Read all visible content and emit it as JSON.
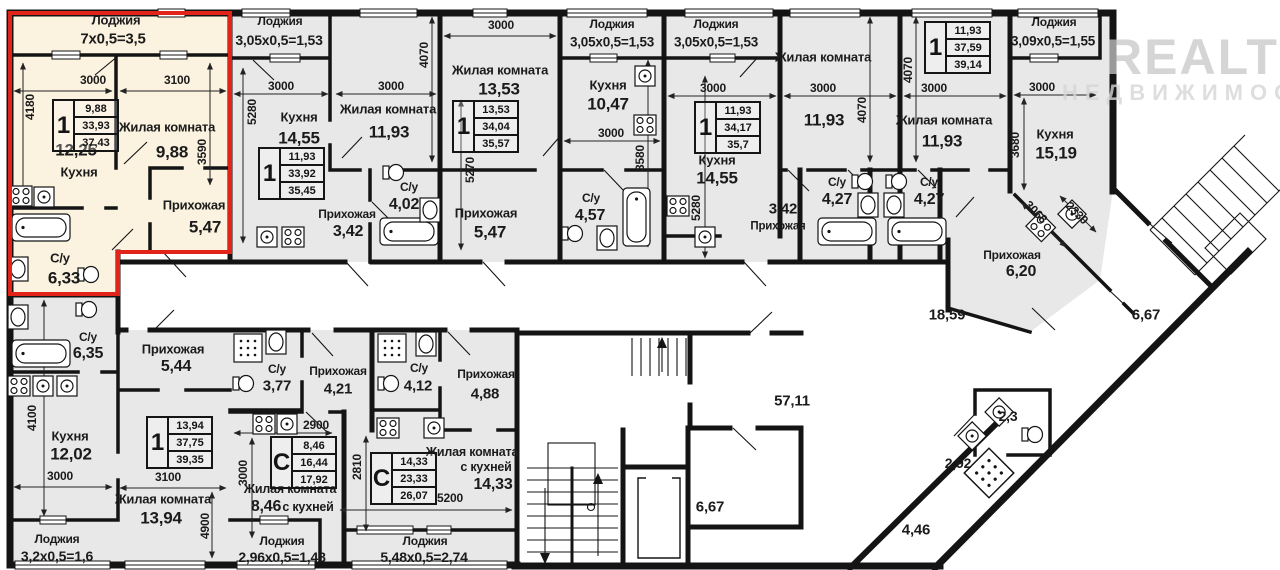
{
  "watermark": {
    "brand": "REALT",
    "sub": "НЕДВИЖИМОСТЬ"
  },
  "icons": [
    "bathtub-icon",
    "toilet-icon",
    "sink-icon",
    "stove-icon",
    "kitchen-sink-icon",
    "shower-icon",
    "elevator-icon",
    "stairs-icon",
    "window-icon",
    "door-swing-icon"
  ],
  "highlight_color": "#e2231a",
  "cards": [
    {
      "x": 52,
      "y": 99,
      "rooms": "1",
      "values": [
        "9,88",
        "33,93",
        "37,43"
      ]
    },
    {
      "x": 258,
      "y": 147,
      "rooms": "1",
      "values": [
        "11,93",
        "33,92",
        "35,45"
      ]
    },
    {
      "x": 452,
      "y": 100,
      "rooms": "1",
      "values": [
        "13,53",
        "34,04",
        "35,57"
      ]
    },
    {
      "x": 694,
      "y": 101,
      "rooms": "1",
      "values": [
        "11,93",
        "34,17",
        "35,7"
      ]
    },
    {
      "x": 924,
      "y": 21,
      "rooms": "1",
      "values": [
        "11,93",
        "37,59",
        "39,14"
      ]
    },
    {
      "x": 146,
      "y": 416,
      "rooms": "1",
      "values": [
        "13,94",
        "37,75",
        "39,35"
      ]
    },
    {
      "x": 270,
      "y": 436,
      "rooms": "С",
      "values": [
        "8,46",
        "16,44",
        "17,92"
      ]
    },
    {
      "x": 370,
      "y": 452,
      "rooms": "С",
      "values": [
        "14,33",
        "23,33",
        "26,07"
      ]
    }
  ],
  "labels": [
    {
      "t": "Лоджия",
      "x": 116,
      "y": 20,
      "fs": 13
    },
    {
      "t": "7х0,5=3,5",
      "x": 113,
      "y": 39,
      "fs": 15
    },
    {
      "t": "3000",
      "x": 93,
      "y": 80,
      "fs": 12
    },
    {
      "t": "3100",
      "x": 177,
      "y": 80,
      "fs": 12
    },
    {
      "t": "4180",
      "x": 30,
      "y": 107,
      "fs": 12,
      "r": -90
    },
    {
      "t": "3590",
      "x": 202,
      "y": 152,
      "fs": 12,
      "r": -90
    },
    {
      "t": "12,25",
      "x": 76,
      "y": 150,
      "fs": 17
    },
    {
      "t": "Кухня",
      "x": 79,
      "y": 172,
      "fs": 13
    },
    {
      "t": "Жилая комната",
      "x": 167,
      "y": 127,
      "fs": 13
    },
    {
      "t": "9,88",
      "x": 172,
      "y": 152,
      "fs": 17
    },
    {
      "t": "Прихожая",
      "x": 194,
      "y": 205,
      "fs": 13
    },
    {
      "t": "5,47",
      "x": 205,
      "y": 227,
      "fs": 17
    },
    {
      "t": "С/у",
      "x": 60,
      "y": 258,
      "fs": 13
    },
    {
      "t": "6,33",
      "x": 64,
      "y": 278,
      "fs": 17
    },
    {
      "t": "Лоджия",
      "x": 280,
      "y": 21,
      "fs": 12
    },
    {
      "t": "3,05х0,5=1,53",
      "x": 279,
      "y": 40,
      "fs": 14
    },
    {
      "t": "3000",
      "x": 281,
      "y": 86,
      "fs": 12
    },
    {
      "t": "3000",
      "x": 391,
      "y": 86,
      "fs": 12
    },
    {
      "t": "5280",
      "x": 252,
      "y": 112,
      "fs": 12,
      "r": -90
    },
    {
      "t": "4070",
      "x": 424,
      "y": 55,
      "fs": 12,
      "r": -90
    },
    {
      "t": "Кухня",
      "x": 299,
      "y": 117,
      "fs": 13
    },
    {
      "t": "14,55",
      "x": 299,
      "y": 138,
      "fs": 17
    },
    {
      "t": "Жилая комната",
      "x": 388,
      "y": 109,
      "fs": 13
    },
    {
      "t": "11,93",
      "x": 389,
      "y": 132,
      "fs": 17
    },
    {
      "t": "Прихожая",
      "x": 347,
      "y": 214,
      "fs": 12
    },
    {
      "t": "3,42",
      "x": 348,
      "y": 232,
      "fs": 16
    },
    {
      "t": "С/у",
      "x": 409,
      "y": 187,
      "fs": 12
    },
    {
      "t": "4,02",
      "x": 404,
      "y": 205,
      "fs": 16
    },
    {
      "t": "3000",
      "x": 501,
      "y": 25,
      "fs": 12
    },
    {
      "t": "Жилая комната",
      "x": 500,
      "y": 70,
      "fs": 13
    },
    {
      "t": "13,53",
      "x": 499,
      "y": 89,
      "fs": 17
    },
    {
      "t": "5270",
      "x": 470,
      "y": 170,
      "fs": 12,
      "r": -90
    },
    {
      "t": "Прихожая",
      "x": 486,
      "y": 213,
      "fs": 13
    },
    {
      "t": "5,47",
      "x": 490,
      "y": 232,
      "fs": 17
    },
    {
      "t": "Лоджия",
      "x": 612,
      "y": 24,
      "fs": 12
    },
    {
      "t": "3,05х0,5=1,53",
      "x": 612,
      "y": 42,
      "fs": 13.5
    },
    {
      "t": "Кухня",
      "x": 608,
      "y": 85,
      "fs": 13
    },
    {
      "t": "10,47",
      "x": 608,
      "y": 104,
      "fs": 17
    },
    {
      "t": "3000",
      "x": 611,
      "y": 133,
      "fs": 12
    },
    {
      "t": "3580",
      "x": 640,
      "y": 158,
      "fs": 12,
      "r": -90
    },
    {
      "t": "С/у",
      "x": 591,
      "y": 198,
      "fs": 12
    },
    {
      "t": "4,57",
      "x": 590,
      "y": 216,
      "fs": 16
    },
    {
      "t": "Лоджия",
      "x": 716,
      "y": 24,
      "fs": 12
    },
    {
      "t": "3,05х0,5=1,53",
      "x": 716,
      "y": 42,
      "fs": 13.5
    },
    {
      "t": "3000",
      "x": 713,
      "y": 88,
      "fs": 12
    },
    {
      "t": "Кухня",
      "x": 717,
      "y": 160,
      "fs": 13
    },
    {
      "t": "14,55",
      "x": 717,
      "y": 178,
      "fs": 17
    },
    {
      "t": "5280",
      "x": 696,
      "y": 208,
      "fs": 12,
      "r": -90
    },
    {
      "t": "Жилая комната",
      "x": 823,
      "y": 57,
      "fs": 13
    },
    {
      "t": "3000",
      "x": 823,
      "y": 88,
      "fs": 12
    },
    {
      "t": "11,93",
      "x": 824,
      "y": 120,
      "fs": 17
    },
    {
      "t": "4070",
      "x": 862,
      "y": 110,
      "fs": 12,
      "r": -90
    },
    {
      "t": "Прихожая",
      "x": 778,
      "y": 227,
      "fs": 11.5
    },
    {
      "t": "3,42",
      "x": 783,
      "y": 209,
      "fs": 15
    },
    {
      "t": "С/у",
      "x": 837,
      "y": 182,
      "fs": 12
    },
    {
      "t": "4,27",
      "x": 837,
      "y": 200,
      "fs": 16
    },
    {
      "t": "4070",
      "x": 908,
      "y": 70,
      "fs": 12,
      "r": -90
    },
    {
      "t": "3000",
      "x": 934,
      "y": 88,
      "fs": 12
    },
    {
      "t": "Жилая комната",
      "x": 944,
      "y": 120,
      "fs": 13
    },
    {
      "t": "11,93",
      "x": 942,
      "y": 141,
      "fs": 17
    },
    {
      "t": "С/у",
      "x": 929,
      "y": 182,
      "fs": 12
    },
    {
      "t": "4,27",
      "x": 929,
      "y": 200,
      "fs": 16
    },
    {
      "t": "Лоджия",
      "x": 1054,
      "y": 22,
      "fs": 12
    },
    {
      "t": "3,09х0,5=1,55",
      "x": 1053,
      "y": 41,
      "fs": 13.5
    },
    {
      "t": "3000",
      "x": 1042,
      "y": 87,
      "fs": 12
    },
    {
      "t": "3680",
      "x": 1015,
      "y": 145,
      "fs": 12,
      "r": -90
    },
    {
      "t": "Кухня",
      "x": 1055,
      "y": 134,
      "fs": 13
    },
    {
      "t": "15,19",
      "x": 1056,
      "y": 153,
      "fs": 17
    },
    {
      "t": "3068",
      "x": 1036,
      "y": 212,
      "fs": 12,
      "r": 45
    },
    {
      "t": "2330",
      "x": 1077,
      "y": 213,
      "fs": 12,
      "r": 45
    },
    {
      "t": "Прихожая",
      "x": 1012,
      "y": 255,
      "fs": 12
    },
    {
      "t": "6,20",
      "x": 1021,
      "y": 272,
      "fs": 16
    },
    {
      "t": "18,59",
      "x": 947,
      "y": 315,
      "fs": 15,
      "n": "corridor-area-label"
    },
    {
      "t": "57,11",
      "x": 792,
      "y": 401,
      "fs": 15,
      "n": "corridor-area-label"
    },
    {
      "t": "6,67",
      "x": 1146,
      "y": 315,
      "fs": 15,
      "n": "corridor-area-label"
    },
    {
      "t": "6,67",
      "x": 710,
      "y": 507,
      "fs": 15,
      "n": "corridor-area-label"
    },
    {
      "t": "4,46",
      "x": 916,
      "y": 530,
      "fs": 15,
      "n": "corridor-area-label"
    },
    {
      "t": "2,92",
      "x": 958,
      "y": 463,
      "fs": 14,
      "n": "corridor-area-label"
    },
    {
      "t": "2,3",
      "x": 1008,
      "y": 416,
      "fs": 14,
      "n": "corridor-area-label"
    },
    {
      "t": "С/у",
      "x": 88,
      "y": 337,
      "fs": 12
    },
    {
      "t": "6,35",
      "x": 88,
      "y": 354,
      "fs": 16
    },
    {
      "t": "Прихожая",
      "x": 173,
      "y": 349,
      "fs": 13
    },
    {
      "t": "5,44",
      "x": 176,
      "y": 367,
      "fs": 16
    },
    {
      "t": "4100",
      "x": 32,
      "y": 418,
      "fs": 12,
      "r": -90
    },
    {
      "t": "Кухня",
      "x": 70,
      "y": 436,
      "fs": 13
    },
    {
      "t": "12,02",
      "x": 71,
      "y": 454,
      "fs": 17
    },
    {
      "t": "3000",
      "x": 60,
      "y": 476,
      "fs": 12
    },
    {
      "t": "3100",
      "x": 168,
      "y": 477,
      "fs": 12
    },
    {
      "t": "Жилая комната",
      "x": 163,
      "y": 499,
      "fs": 13
    },
    {
      "t": "13,94",
      "x": 161,
      "y": 518,
      "fs": 17
    },
    {
      "t": "4900",
      "x": 205,
      "y": 526,
      "fs": 12,
      "r": -90
    },
    {
      "t": "Лоджия",
      "x": 57,
      "y": 539,
      "fs": 12
    },
    {
      "t": "3,2х0,5=1,6",
      "x": 57,
      "y": 556,
      "fs": 14
    },
    {
      "t": "С/у",
      "x": 277,
      "y": 369,
      "fs": 12
    },
    {
      "t": "3,77",
      "x": 277,
      "y": 386,
      "fs": 15
    },
    {
      "t": "Прихожая",
      "x": 338,
      "y": 371,
      "fs": 12
    },
    {
      "t": "4,21",
      "x": 338,
      "y": 389,
      "fs": 15
    },
    {
      "t": "2900",
      "x": 316,
      "y": 425,
      "fs": 12
    },
    {
      "t": "3000",
      "x": 243,
      "y": 473,
      "fs": 12,
      "r": -90
    },
    {
      "t": "Жилая комната",
      "x": 290,
      "y": 489,
      "fs": 12.5
    },
    {
      "t": "8,46",
      "x": 266,
      "y": 507,
      "fs": 16
    },
    {
      "t": "с кухней",
      "x": 308,
      "y": 507,
      "fs": 12.5
    },
    {
      "t": "Лоджия",
      "x": 282,
      "y": 541,
      "fs": 12
    },
    {
      "t": "2,96х0,5=1,48",
      "x": 282,
      "y": 557,
      "fs": 14
    },
    {
      "t": "С/у",
      "x": 419,
      "y": 368,
      "fs": 12
    },
    {
      "t": "4,12",
      "x": 418,
      "y": 386,
      "fs": 15
    },
    {
      "t": "Прихожая",
      "x": 486,
      "y": 374,
      "fs": 12
    },
    {
      "t": "4,88",
      "x": 485,
      "y": 394,
      "fs": 15
    },
    {
      "t": "2810",
      "x": 357,
      "y": 467,
      "fs": 12,
      "r": -90
    },
    {
      "t": "Жилая комната",
      "x": 472,
      "y": 452,
      "fs": 12.5
    },
    {
      "t": "с кухней",
      "x": 486,
      "y": 467,
      "fs": 12.5
    },
    {
      "t": "14,33",
      "x": 493,
      "y": 485,
      "fs": 16
    },
    {
      "t": "5200",
      "x": 450,
      "y": 498,
      "fs": 12
    },
    {
      "t": "Лоджия",
      "x": 425,
      "y": 541,
      "fs": 12
    },
    {
      "t": "5,48х0,5=2,74",
      "x": 424,
      "y": 557,
      "fs": 14
    }
  ]
}
